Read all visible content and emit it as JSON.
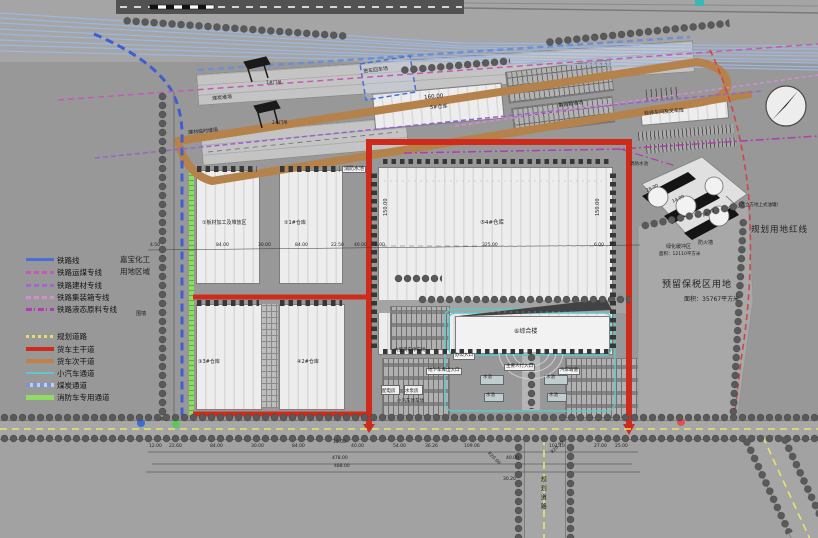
{
  "legend": {
    "rail": [
      {
        "label": "铁路线",
        "color": "#4a6fd4"
      },
      {
        "label": "铁路运煤专线",
        "color": "#c45ab8"
      },
      {
        "label": "铁路建材专线",
        "color": "#a565d2"
      },
      {
        "label": "铁路集装箱专线",
        "color": "#d78ad7"
      },
      {
        "label": "铁路液态原料专线",
        "color": "#b23ab2"
      }
    ],
    "road": [
      {
        "label": "规划道路",
        "color": "#e4de66"
      },
      {
        "label": "货车主干道",
        "color": "#cf2b1d"
      },
      {
        "label": "货车次干道",
        "color": "#c08048"
      },
      {
        "label": "小汽车通道",
        "color": "#62c6c6"
      },
      {
        "label": "煤炭通道",
        "color": "#7a95d6"
      },
      {
        "label": "消防车专用通道",
        "color": "#8fdc64"
      }
    ]
  },
  "zones": {
    "chemical_line1": "嘉宝化工",
    "chemical_line2": "用地区域",
    "wall": "围墙",
    "coal_yard": "煤炭堆场",
    "material_yard": "建材临时堆场",
    "crane1": "1#门吊",
    "crane2": "2#门吊",
    "truck_return": "货车回车场",
    "container_yard": "集装箱堆场",
    "workshop": "检修车间及叉车库",
    "fire_pool": "消防水池",
    "firewall": "防火墙",
    "buffer": "绿化缓冲区",
    "buffer_area": "面积：12110平方米",
    "red_line": "规划用地红线",
    "bonded": "预留保税区用地",
    "bonded_area": "面积：35767平方米",
    "tank_note": "（万立方地上式油罐）",
    "planned_road": "规划道路"
  },
  "buildings": {
    "plate": "①板材加工及堆放区",
    "wh1": "②1#仓库",
    "wh3": "③3#仓库",
    "wh2": "④2#仓库",
    "wh4": "⑤4#仓库",
    "wh5_len": "160.00",
    "wh5": "5#仓库",
    "office": "⑥综合楼"
  },
  "facility": {
    "main_entry": "主要人行入口",
    "office_entry": "办公入口",
    "garage_entry": "地下车库出入口",
    "ramp": "汽车坡道",
    "pool": "水池",
    "truck_park": "大型货车停车场",
    "car_park": "小汽车停车场",
    "power": "配电房",
    "pump": "水泵房"
  },
  "dims": {
    "mid": [
      "4.50",
      "84.00",
      "30.00",
      "84.00",
      "22.50",
      "40.00",
      "6.00",
      "325.00",
      "6.00",
      "25"
    ],
    "wh4_h": "150.00",
    "tank": [
      "28.00",
      "14.00",
      "14.00"
    ],
    "bottom": [
      "12.00",
      "22.60",
      "84.00",
      "30.00",
      "84.00",
      "15.00",
      "40.00",
      "54.00",
      "36.26",
      "109.06",
      "101.10",
      "27.00",
      "25.00"
    ],
    "totals": [
      "478.00",
      "488.00"
    ],
    "radius": "R20.00",
    "road_w": "40.00",
    "offset": "30.20"
  },
  "markers": {
    "colors": [
      "#3a6fd4",
      "#59c959",
      "#e05050",
      "#3ab8b8"
    ]
  }
}
